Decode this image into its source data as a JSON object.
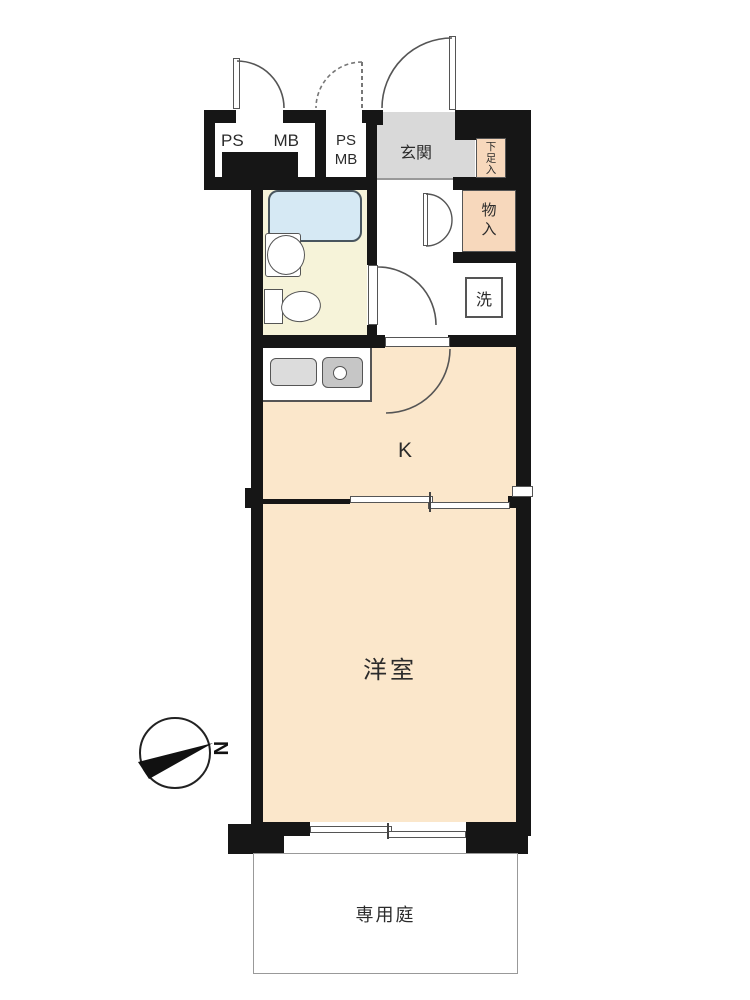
{
  "page": {
    "type": "japanese-apartment-floor-plan"
  },
  "labels": {
    "ps1_left": "PS",
    "ps1_right": "MB",
    "ps2_top": "PS",
    "ps2_bottom": "MB",
    "entrance": "玄関",
    "shoe_cabinet": "下足入",
    "closet": "物入",
    "laundry": "洗",
    "kitchen": "K",
    "western_room": "洋室",
    "private_garden": "専用庭"
  },
  "compass": {
    "north_label": "N"
  },
  "colors": {
    "wall": "#161616",
    "room_floor": "#fbe7cb",
    "bathroom_floor": "#f6f3d9",
    "bathtub": "#d6e9f4",
    "entrance_floor": "#d9d9d9",
    "closet_fill": "#f7d8bc",
    "counter_left": "#dcdcdc",
    "counter_sink": "#c6c6c6",
    "outline": "#555555"
  }
}
